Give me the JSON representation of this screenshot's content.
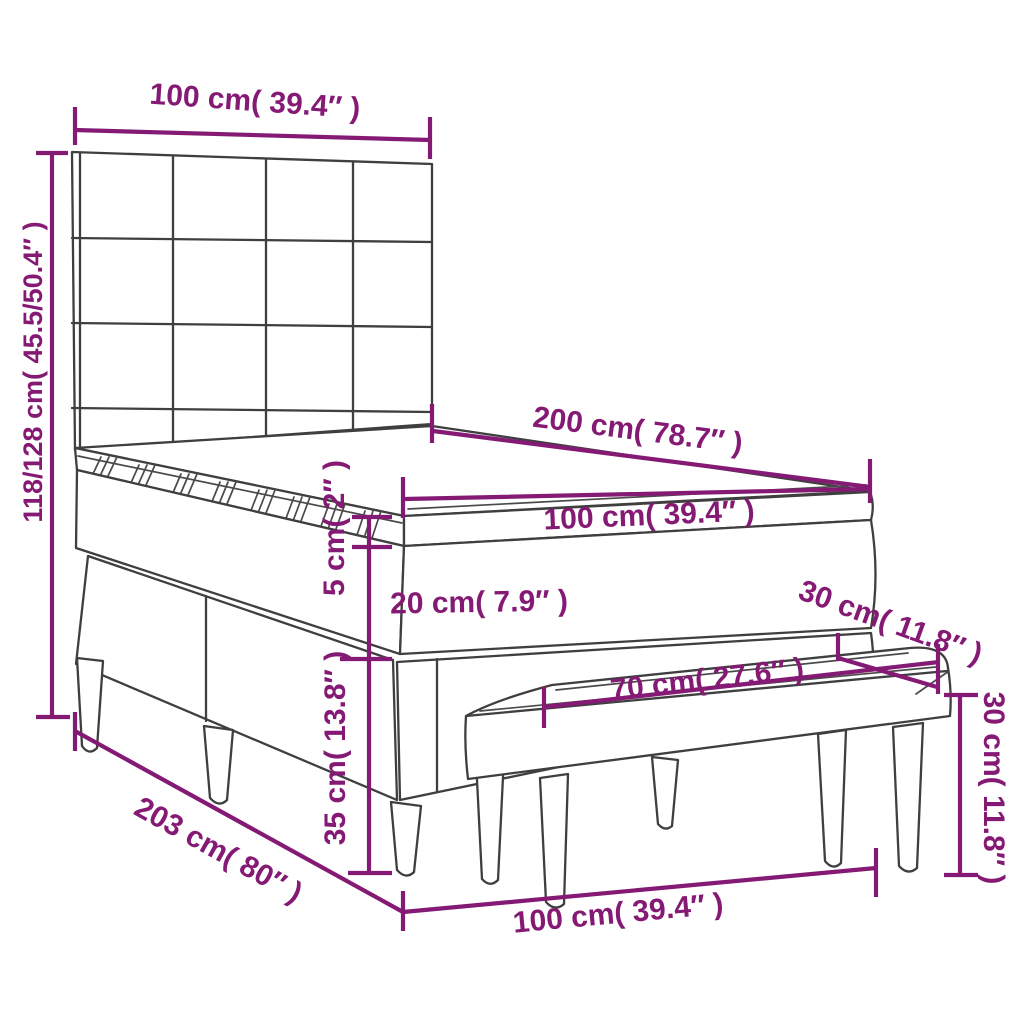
{
  "diagram": {
    "accent_color": "#851a75",
    "line_color": "#3f3f3f",
    "background": "#ffffff",
    "dimensions": {
      "headboard_width": "100 cm( 39.4″ )",
      "overall_height": "118/128 cm( 45.5/50.4″ )",
      "mattress_length": "200 cm( 78.7″ )",
      "mattress_width": "100 cm( 39.4″ )",
      "topper_thickness": "5 cm( 2″ )",
      "mattress_thickness": "20 cm( 7.9″ )",
      "base_height": "35 cm( 13.8″ )",
      "base_length": "203 cm( 80″ )",
      "bench_seat_length": "70 cm( 27.6″ )",
      "bench_depth": "30 cm( 11.8″ )",
      "bench_height": "30 cm( 11.8″ )",
      "bench_length": "100 cm( 39.4″ )"
    }
  }
}
